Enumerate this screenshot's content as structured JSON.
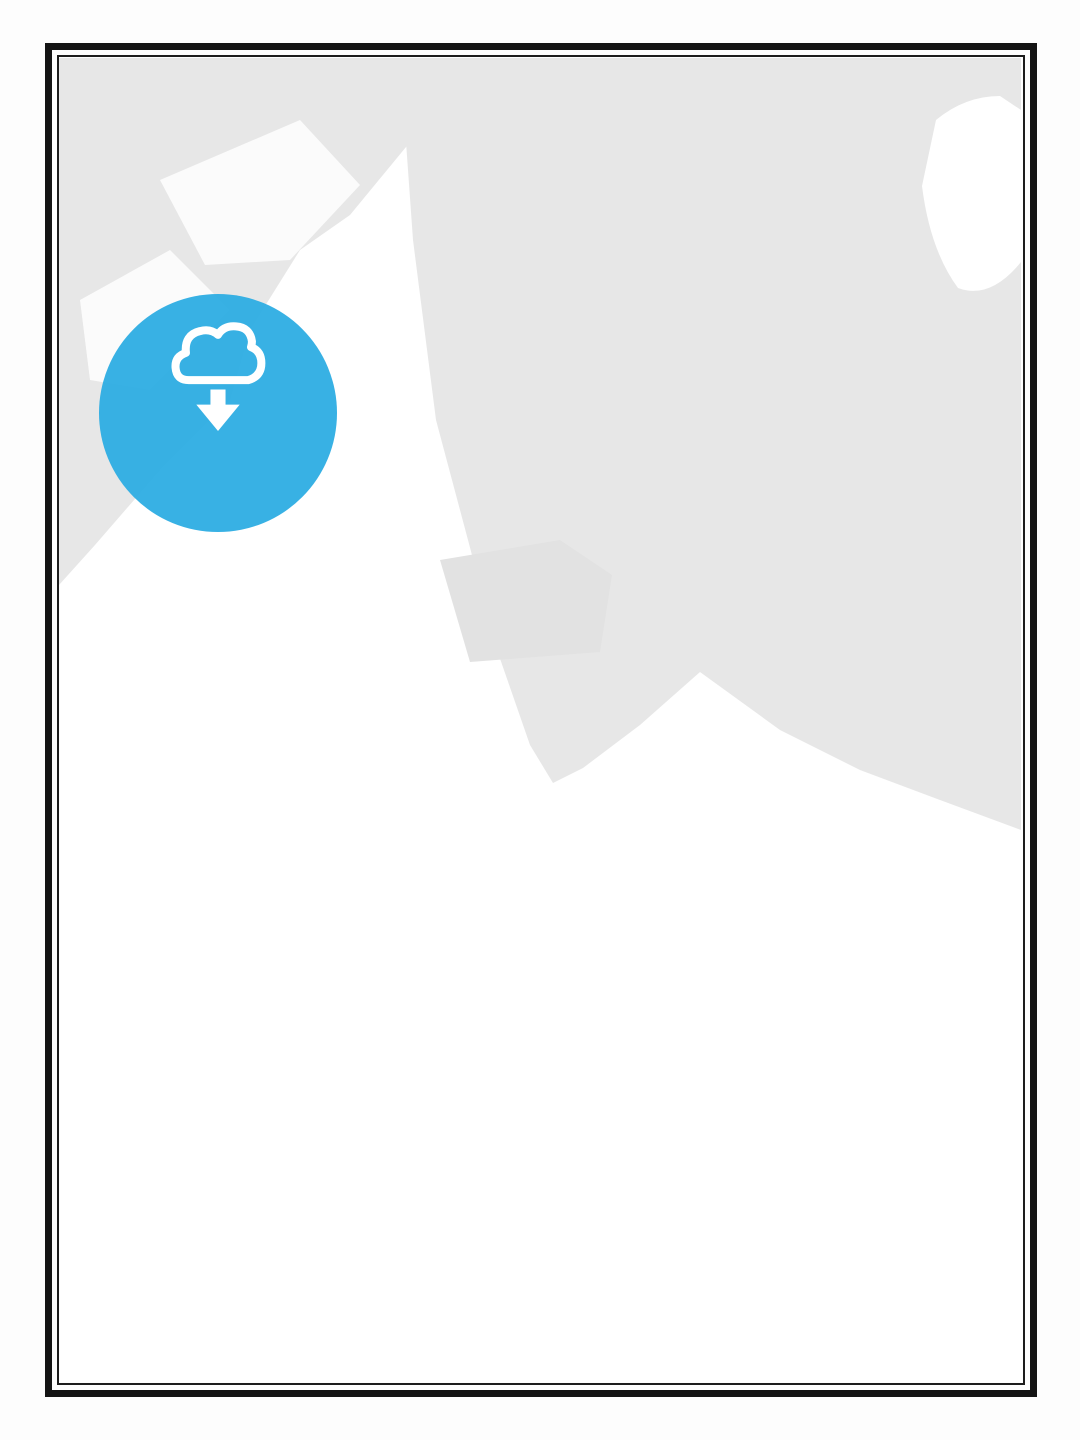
{
  "poster": {
    "title": "БЕРДЯНСЬК",
    "country": "УКРАЇНА",
    "coordinates": {
      "lat": "46.774° N",
      "separator": "|",
      "lon": "36.803° E"
    }
  },
  "badge": {
    "label": "LICENSABLE",
    "icon": "cloud-download-icon",
    "color": "#29abe2"
  },
  "watermarks": {
    "script_top": "Maps",
    "block_heb": "HEB",
    "block_streits": "STREITS",
    "script_bottom": "Sketches",
    "heb": "HEB",
    "vertical": "STREIT"
  },
  "map": {
    "colors": {
      "land": "#e7e7e7",
      "urban": "#ffffff",
      "road_major": "#161616",
      "road_medium": "#3d3d3d",
      "road_minor": "#8f8f8f",
      "water_line": "#d6d6d6",
      "coast_line": "#b5b5b5",
      "title_text": "#1b1b1b"
    }
  }
}
